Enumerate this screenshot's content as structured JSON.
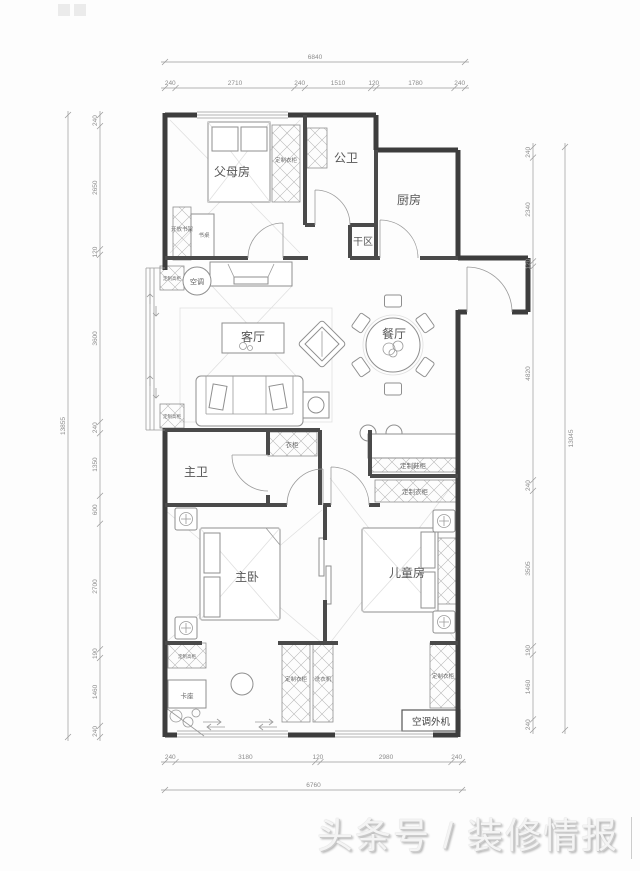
{
  "watermark": {
    "text": "头条号 / 装修情报"
  },
  "rooms": {
    "parents": "父母房",
    "public_bath": "公卫",
    "kitchen": "厨房",
    "dry_area": "干区",
    "living": "客厅",
    "dining": "餐厅",
    "master_bath": "主卫",
    "master_bed": "主卧",
    "kids": "儿童房"
  },
  "fixtures": {
    "ac": "空调",
    "ac_outdoor": "空调外机",
    "custom_wardrobe": "定制衣柜",
    "custom_tall_cabinet": "定制高柜",
    "open_bookshelf": "开放书架",
    "desk": "书桌",
    "wardrobe": "衣柜",
    "shoe_cabinet": "定制鞋柜",
    "bench_seat": "卡座",
    "washing_machine": "洗衣机"
  },
  "dimensions": {
    "top": {
      "total": "6840",
      "segments": [
        "240",
        "2710",
        "240",
        "1510",
        "120",
        "1780",
        "240"
      ]
    },
    "bottom": {
      "total": "6760",
      "segments": [
        "240",
        "3180",
        "120",
        "2980",
        "240"
      ]
    },
    "left": {
      "total": "13855",
      "segments": [
        "240",
        "2650",
        "120",
        "3600",
        "240",
        "1350",
        "600",
        "2700",
        "190",
        "1460",
        "240"
      ]
    },
    "right": {
      "total": "13045",
      "segments": [
        "240",
        "2340",
        "120",
        "4820",
        "240",
        "3505",
        "190",
        "1460",
        "240"
      ]
    }
  }
}
